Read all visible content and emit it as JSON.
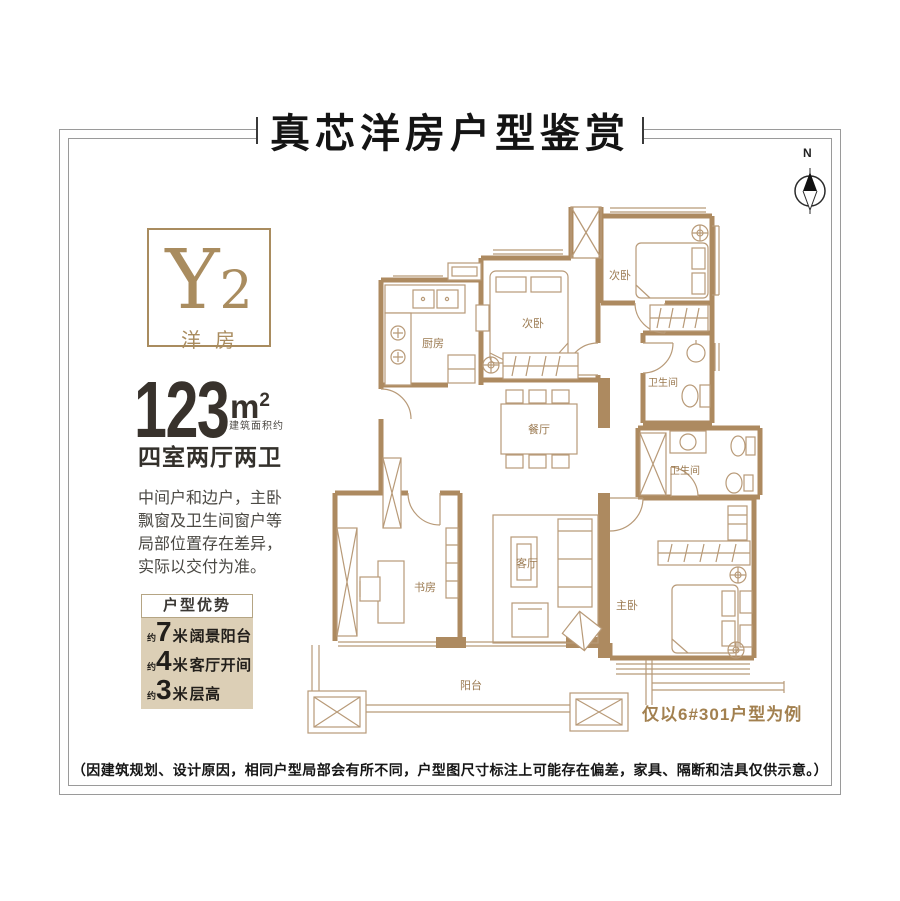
{
  "page": {
    "title": "真芯洋房户型鉴赏",
    "compass_label": "N",
    "example_note": "仅以6#301户型为例",
    "disclaimer": "（因建筑规划、设计原因，相同户型局部会有所不同，户型图尺寸标注上可能存在偏差，家具、隔断和洁具仅供示意。）"
  },
  "unit": {
    "code_letter": "Y",
    "code_number": "2",
    "type_label": "洋房",
    "area_value": "123",
    "area_unit_base": "m",
    "area_unit_sup": "2",
    "area_note": "建筑面积约",
    "rooms_summary": "四室两厅两卫",
    "remark_lines": {
      "l1": "中间户和边户，主卧",
      "l2": "飘窗及卫生间窗户等",
      "l3": "局部位置存在差异，",
      "l4": "实际以交付为准。"
    }
  },
  "advantages": {
    "title": "户型优势",
    "items": [
      {
        "approx": "约",
        "value": "7",
        "unit": "米",
        "label": "阔景阳台"
      },
      {
        "approx": "约",
        "value": "4",
        "unit": "米",
        "label": "客厅开间"
      },
      {
        "approx": "约",
        "value": "3",
        "unit": "米",
        "label": "层高"
      }
    ]
  },
  "floorplan": {
    "rooms": [
      {
        "name": "厨房"
      },
      {
        "name": "次卧"
      },
      {
        "name": "次卧"
      },
      {
        "name": "卫生间"
      },
      {
        "name": "卫生间"
      },
      {
        "name": "餐厅"
      },
      {
        "name": "客厅"
      },
      {
        "name": "书房"
      },
      {
        "name": "主卧"
      },
      {
        "name": "阳台"
      }
    ]
  },
  "colors": {
    "gold": "#a98c5f",
    "wall": "#ad8a60",
    "thin_line": "#b89a78",
    "panel_bg": "#dccfb6",
    "label": "#9b7a51"
  }
}
